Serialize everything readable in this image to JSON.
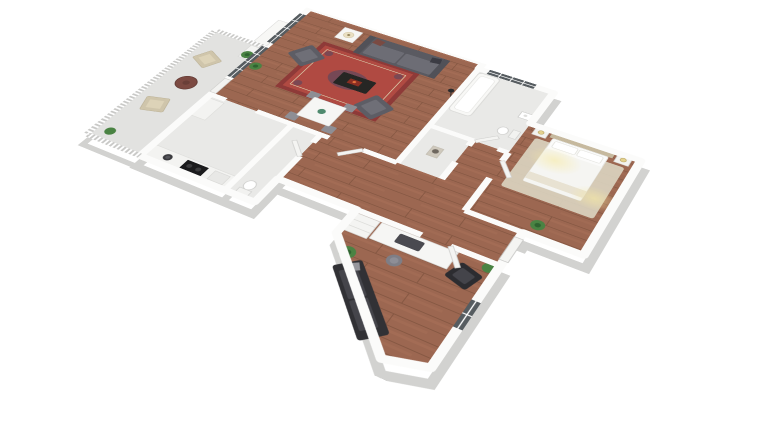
{
  "scene": {
    "type": "3d-floorplan-render",
    "view": "isometric-top-down",
    "background": "#ffffff",
    "apartment": {
      "rooms": [
        {
          "id": "living-room",
          "floor": "hardwood",
          "furniture": [
            "gray-sofa",
            "armchair",
            "armchair",
            "coffee-table",
            "red-oriental-rug",
            "side-table-with-lamp",
            "floor-lamp",
            "dining-table",
            "dining-chairs-x4",
            "potted-plant"
          ],
          "features": [
            "windows-left-wall",
            "balcony-door",
            "fireplace-bump"
          ]
        },
        {
          "id": "kitchen",
          "floor": "light-tile",
          "furniture": [
            "counter-run",
            "sink",
            "cooktop",
            "tall-cabinet"
          ]
        },
        {
          "id": "wc",
          "floor": "light-tile",
          "furniture": [
            "toilet"
          ]
        },
        {
          "id": "bathroom",
          "floor": "light-tile",
          "furniture": [
            "bathtub",
            "toilet",
            "washbasin"
          ],
          "features": [
            "window-top-wall"
          ]
        },
        {
          "id": "hallway",
          "floor": "hardwood",
          "furniture": [
            "statue-niche"
          ]
        },
        {
          "id": "bedroom",
          "floor": "hardwood",
          "furniture": [
            "double-bed",
            "tan-headboard",
            "nightstand",
            "nightstand",
            "bedside-lamps",
            "beige-rug",
            "potted-plant"
          ],
          "features": [
            "warm-ceiling-lights"
          ]
        },
        {
          "id": "office",
          "floor": "hardwood",
          "furniture": [
            "desk",
            "desk-machine",
            "stool",
            "dark-armchair",
            "white-cabinet",
            "dark-sofa",
            "potted-plant",
            "potted-plant"
          ],
          "features": [
            "window-right-wall",
            "entry-door"
          ]
        },
        {
          "id": "balcony",
          "floor": "concrete",
          "furniture": [
            "wicker-armchair",
            "wicker-armchair",
            "round-table",
            "planter-box",
            "potted-plant",
            "potted-plant"
          ],
          "features": [
            "white-railing"
          ]
        }
      ]
    }
  },
  "colors": {
    "wall": "#fbfbfa",
    "wall_shadow": "#d2d2d0",
    "wood_base": "#9c6751",
    "wood_line": "#7e513e",
    "wood_hi": "#b97f63",
    "tile_light": "#e9e9e7",
    "balcony_floor": "#e2e2e0",
    "window_glass": "#565c60",
    "rug_red": "#b04a42",
    "rug_border": "#8e3a38",
    "rug_accent": "#3c4668",
    "sofa_gray": "#5a5a61",
    "sofa_dark": "#313135",
    "armchair_gray": "#5d5d65",
    "bed_white": "#fbfbfa",
    "headboard_tan": "#c6b99e",
    "bedroom_rug": "#dcd5c1",
    "balcony_chair": "#cfc5ab",
    "plant_green": "#4a8343",
    "glow_yellow": "#f7eaa4",
    "counter_white": "#f3f3f1",
    "door_white": "#f4f4f2"
  }
}
